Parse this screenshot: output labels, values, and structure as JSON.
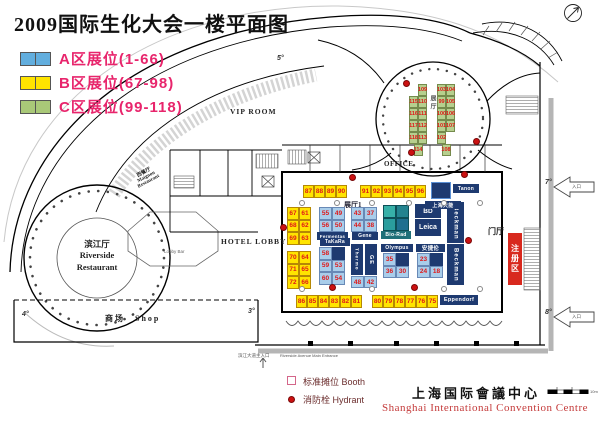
{
  "title": "2009国际生化大会一楼平面图",
  "legend": {
    "items": [
      {
        "label": "A区展位(1-66)",
        "zone": "A",
        "color": "#62aede"
      },
      {
        "label": "B区展位(67-98)",
        "zone": "B",
        "color": "#ffe400"
      },
      {
        "label": "C区展位(99-118)",
        "zone": "C",
        "color": "#a9c878"
      }
    ]
  },
  "rooms": {
    "vip": "VIP ROOM",
    "office": "OFFICE",
    "hotel_lobby": "HOTEL LOBBY",
    "lobby_bar": "Lobby Bar",
    "hall1": "展厅1",
    "rotunda_hall": "展厅",
    "foyer": "门厅",
    "registration": "注册区",
    "riverside_cn": "滨江厅",
    "riverside_en1": "Riverside",
    "riverside_en2": "Restaurant",
    "maignon_cn": "西餐厅",
    "maignon_en1": "Maignon",
    "maignon_en2": "Restaurant",
    "shop": "商场　Shop"
  },
  "entrances": {
    "side_label": "入口",
    "main_cn": "滨江大道主入口",
    "main_en": "Riverside Avenue Main Entrance"
  },
  "markers": {
    "m3": "3°",
    "m4": "4°",
    "m5": "5°",
    "m7": "7°",
    "m8": "8°"
  },
  "booths": {
    "b_top_left": [
      "87",
      "88",
      "89",
      "90"
    ],
    "b_top_right": [
      "91",
      "92",
      "93",
      "94",
      "95",
      "96"
    ],
    "b_bottom_left": [
      "86",
      "85",
      "84",
      "83",
      "82",
      "81"
    ],
    "b_bottom_right": [
      "80",
      "79",
      "78",
      "77",
      "76",
      "75"
    ],
    "b_left_1": [
      [
        "67",
        "61"
      ],
      [
        "68",
        "62"
      ],
      [
        "69",
        "63"
      ]
    ],
    "b_left_2": [
      [
        "70",
        "64"
      ],
      [
        "71",
        "65"
      ],
      [
        "72",
        "66"
      ]
    ],
    "a_fermentas": [
      [
        "55",
        "49"
      ],
      [
        "56",
        "50"
      ]
    ],
    "a_gene": [
      [
        "43",
        "37"
      ],
      [
        "44",
        "38"
      ]
    ],
    "a_takara": [
      [
        "58",
        null
      ],
      [
        "59",
        "53"
      ],
      [
        "60",
        "54"
      ]
    ],
    "a_thermo_ge": [
      "48",
      "42"
    ],
    "a_olympus": [
      [
        "35",
        null
      ],
      [
        "36",
        "30"
      ]
    ],
    "a_agilent": [
      [
        "23",
        null
      ],
      [
        "24",
        "18"
      ]
    ],
    "c_left": {
      "top": "109",
      "pairs": [
        [
          "115",
          "110"
        ],
        [
          "116",
          "111"
        ],
        [
          "117",
          "112"
        ],
        [
          "118",
          "113"
        ]
      ],
      "bottom": "114"
    },
    "c_right": {
      "top": "103",
      "pairs": [
        [
          "104",
          "99"
        ],
        [
          "105",
          "100"
        ],
        [
          "106",
          "101"
        ],
        [
          "107",
          "102"
        ]
      ],
      "bottom": "108"
    }
  },
  "exhibitors": {
    "fermentas": "Fermentas",
    "gene": "Gene",
    "biorad": "Bio-Rad",
    "bd": "BD",
    "leica": "Leica",
    "beckman": "Beckman",
    "takara": "TaKaRa",
    "thermo": "Thermo",
    "ge": "GE",
    "olympus": "Olympus",
    "agilent": "安捷伦",
    "tanon": "Tanon",
    "tanon_cn": "上海天能",
    "eppendorf": "Eppendorf"
  },
  "footer": {
    "booth_legend": "标准摊位 Booth",
    "hydrant_legend": "消防栓 Hydrant",
    "name_cn": "上海国际會議中心",
    "name_en": "Shanghai International Convention Centre",
    "scale_label": "10m"
  },
  "colors": {
    "zone_a": "#62aede",
    "zone_b": "#ffe400",
    "zone_c": "#a9c878",
    "brand_navy": "#1e3a70",
    "biorad_teal": "#2a9d9d",
    "hydrant_red": "#cc1111",
    "registration_red": "#d8291e",
    "legend_text_pink": "#e8256c",
    "booth_number_red": "#e01818"
  }
}
